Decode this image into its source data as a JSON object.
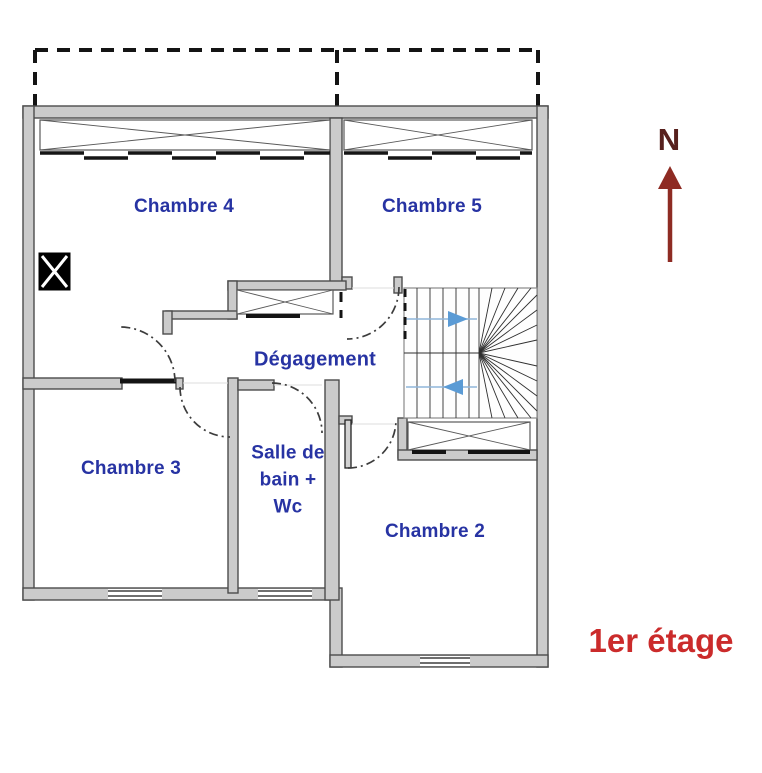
{
  "floor_label": "1er étage",
  "compass": {
    "letter": "N"
  },
  "rooms": [
    {
      "id": "chambre4",
      "label": "Chambre 4"
    },
    {
      "id": "chambre5",
      "label": "Chambre 5"
    },
    {
      "id": "degagement",
      "label": "Dégagement"
    },
    {
      "id": "chambre3",
      "label": "Chambre 3"
    },
    {
      "id": "salle_de_bain_wc",
      "label": "Salle de bain + Wc",
      "lines": [
        "Salle de",
        "bain +",
        "Wc"
      ]
    },
    {
      "id": "chambre2",
      "label": "Chambre 2"
    }
  ],
  "colors": {
    "room_label": "#2733a3",
    "floor_label": "#cb2b2b",
    "compass_letter": "#57201d",
    "north_arrow": "#8e2b23",
    "stair_arrow": "#8fb5da",
    "stair_arrow_head": "#5b9bd5",
    "wall_fill": "#cbcbcb",
    "wall_edge": "#4c4c4c"
  }
}
